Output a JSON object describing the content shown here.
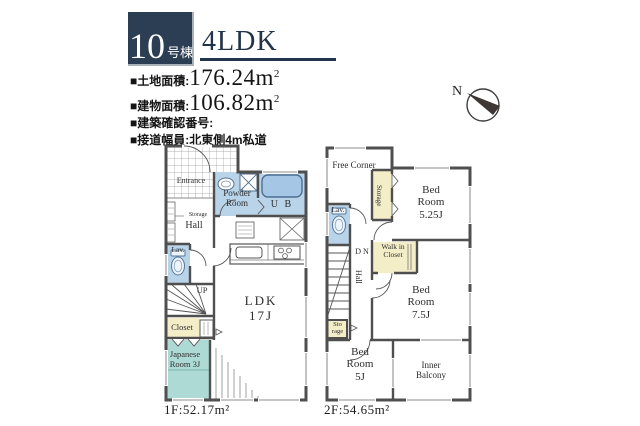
{
  "header": {
    "badge": {
      "number": "10",
      "suffix": "号棟"
    },
    "title": "4LDK",
    "specs": [
      {
        "label": "■土地面積:",
        "value": "176.24m",
        "sup": "2"
      },
      {
        "label": "■建物面積:",
        "value": "106.82m",
        "sup": "2"
      },
      {
        "label": "■建築確認番号:",
        "value": "",
        "sup": ""
      },
      {
        "label": "■接道幅員:北東側4m私道",
        "value": "",
        "sup": ""
      }
    ],
    "compass": {
      "label": "N"
    }
  },
  "floor1": {
    "area_label": "1F:52.17m²",
    "rooms": {
      "entrance": "Entrance",
      "powder_room": "Powder Room",
      "unit_bath": "U B",
      "storage": "Storage",
      "hall": "Hall",
      "lavatory": "Lav.",
      "stairs_up": "UP",
      "closet": "Closet",
      "japanese_room": "Japanese Room 3J",
      "ldk": "LDK 17J"
    }
  },
  "floor2": {
    "area_label": "2F:54.65m²",
    "rooms": {
      "free_corner": "Free Corner",
      "storage": "Storage",
      "bedroom_525": "Bed Room 5.25J",
      "lavatory": "Lav.",
      "stairs_down": "D N",
      "hall": "Hall",
      "walk_in_closet": "Walk in Closet",
      "bedroom_75": "Bed Room 7.5J",
      "storage_small": "Sto rage",
      "bedroom_5": "Bed Room 5J",
      "inner_balcony": "Inner Balcony"
    }
  },
  "colors": {
    "accent_navy": "#2c3e53",
    "room_blue": "#b9d3e9",
    "room_yellow": "#f3edc8",
    "room_teal": "#aedad6",
    "wall": "#4f4f4f"
  }
}
